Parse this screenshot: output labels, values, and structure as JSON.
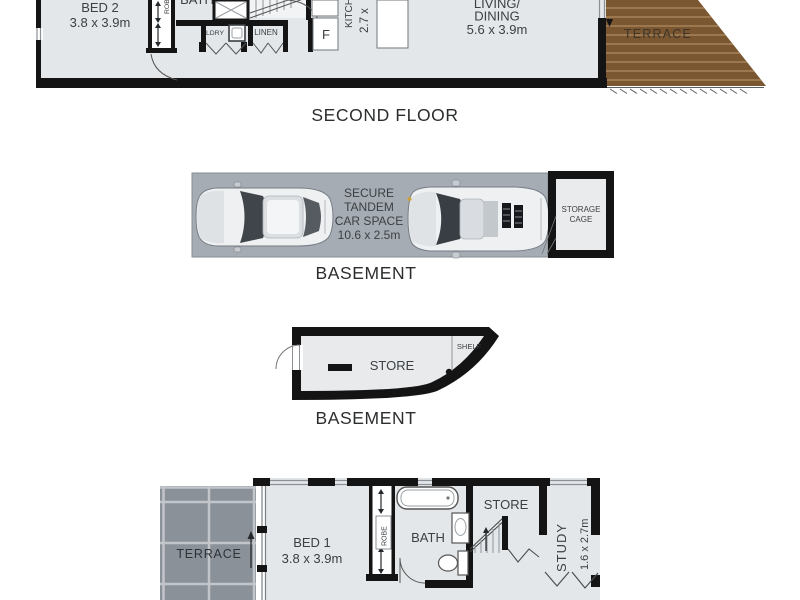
{
  "colors": {
    "floor_fill": "#e4e7e9",
    "wall": "#141414",
    "wood_deck": "#7a5631",
    "wood_plank_line": "#a8835b",
    "garage_floor": "#a6acb3",
    "cage_fill": "#e9ebed",
    "tile_fill": "#8b9199",
    "tile_grout": "#c2c6ca",
    "label_text": "#3c4043",
    "caption_text": "#2b2d2f"
  },
  "captions": {
    "second_floor": "SECOND FLOOR",
    "basement_garage": "BASEMENT",
    "basement_store": "BASEMENT"
  },
  "second_floor": {
    "bed2": {
      "label": "BED 2",
      "dims": "3.8 x 3.9m"
    },
    "robe_label": "ROBE",
    "bath_label": "BATH",
    "laundry_label": "LDRY",
    "linen_label": "LINEN",
    "fridge_label": "F",
    "kitchen": {
      "label": "KITCHEN",
      "dims": "2.7 x"
    },
    "living": {
      "line1": "LIVING/",
      "line2": "DINING",
      "dims": "5.6 x 3.9m"
    },
    "terrace_label": "TERRACE"
  },
  "basement_garage": {
    "car_space": {
      "line1": "SECURE",
      "line2": "TANDEM",
      "line3": "CAR SPACE",
      "dims": "10.6 x 2.5m"
    },
    "storage_cage": {
      "line1": "STORAGE",
      "line2": "CAGE"
    }
  },
  "basement_store": {
    "store_label": "STORE",
    "shelf_label": "SHELF"
  },
  "first_floor": {
    "terrace_label": "TERRACE",
    "bed1": {
      "label": "BED 1",
      "dims": "3.8 x 3.9m"
    },
    "robe_label": "ROBE",
    "bath_label": "BATH",
    "store_label": "STORE",
    "study": {
      "label": "STUDY",
      "dims": "1.6 x 2.7m"
    }
  }
}
